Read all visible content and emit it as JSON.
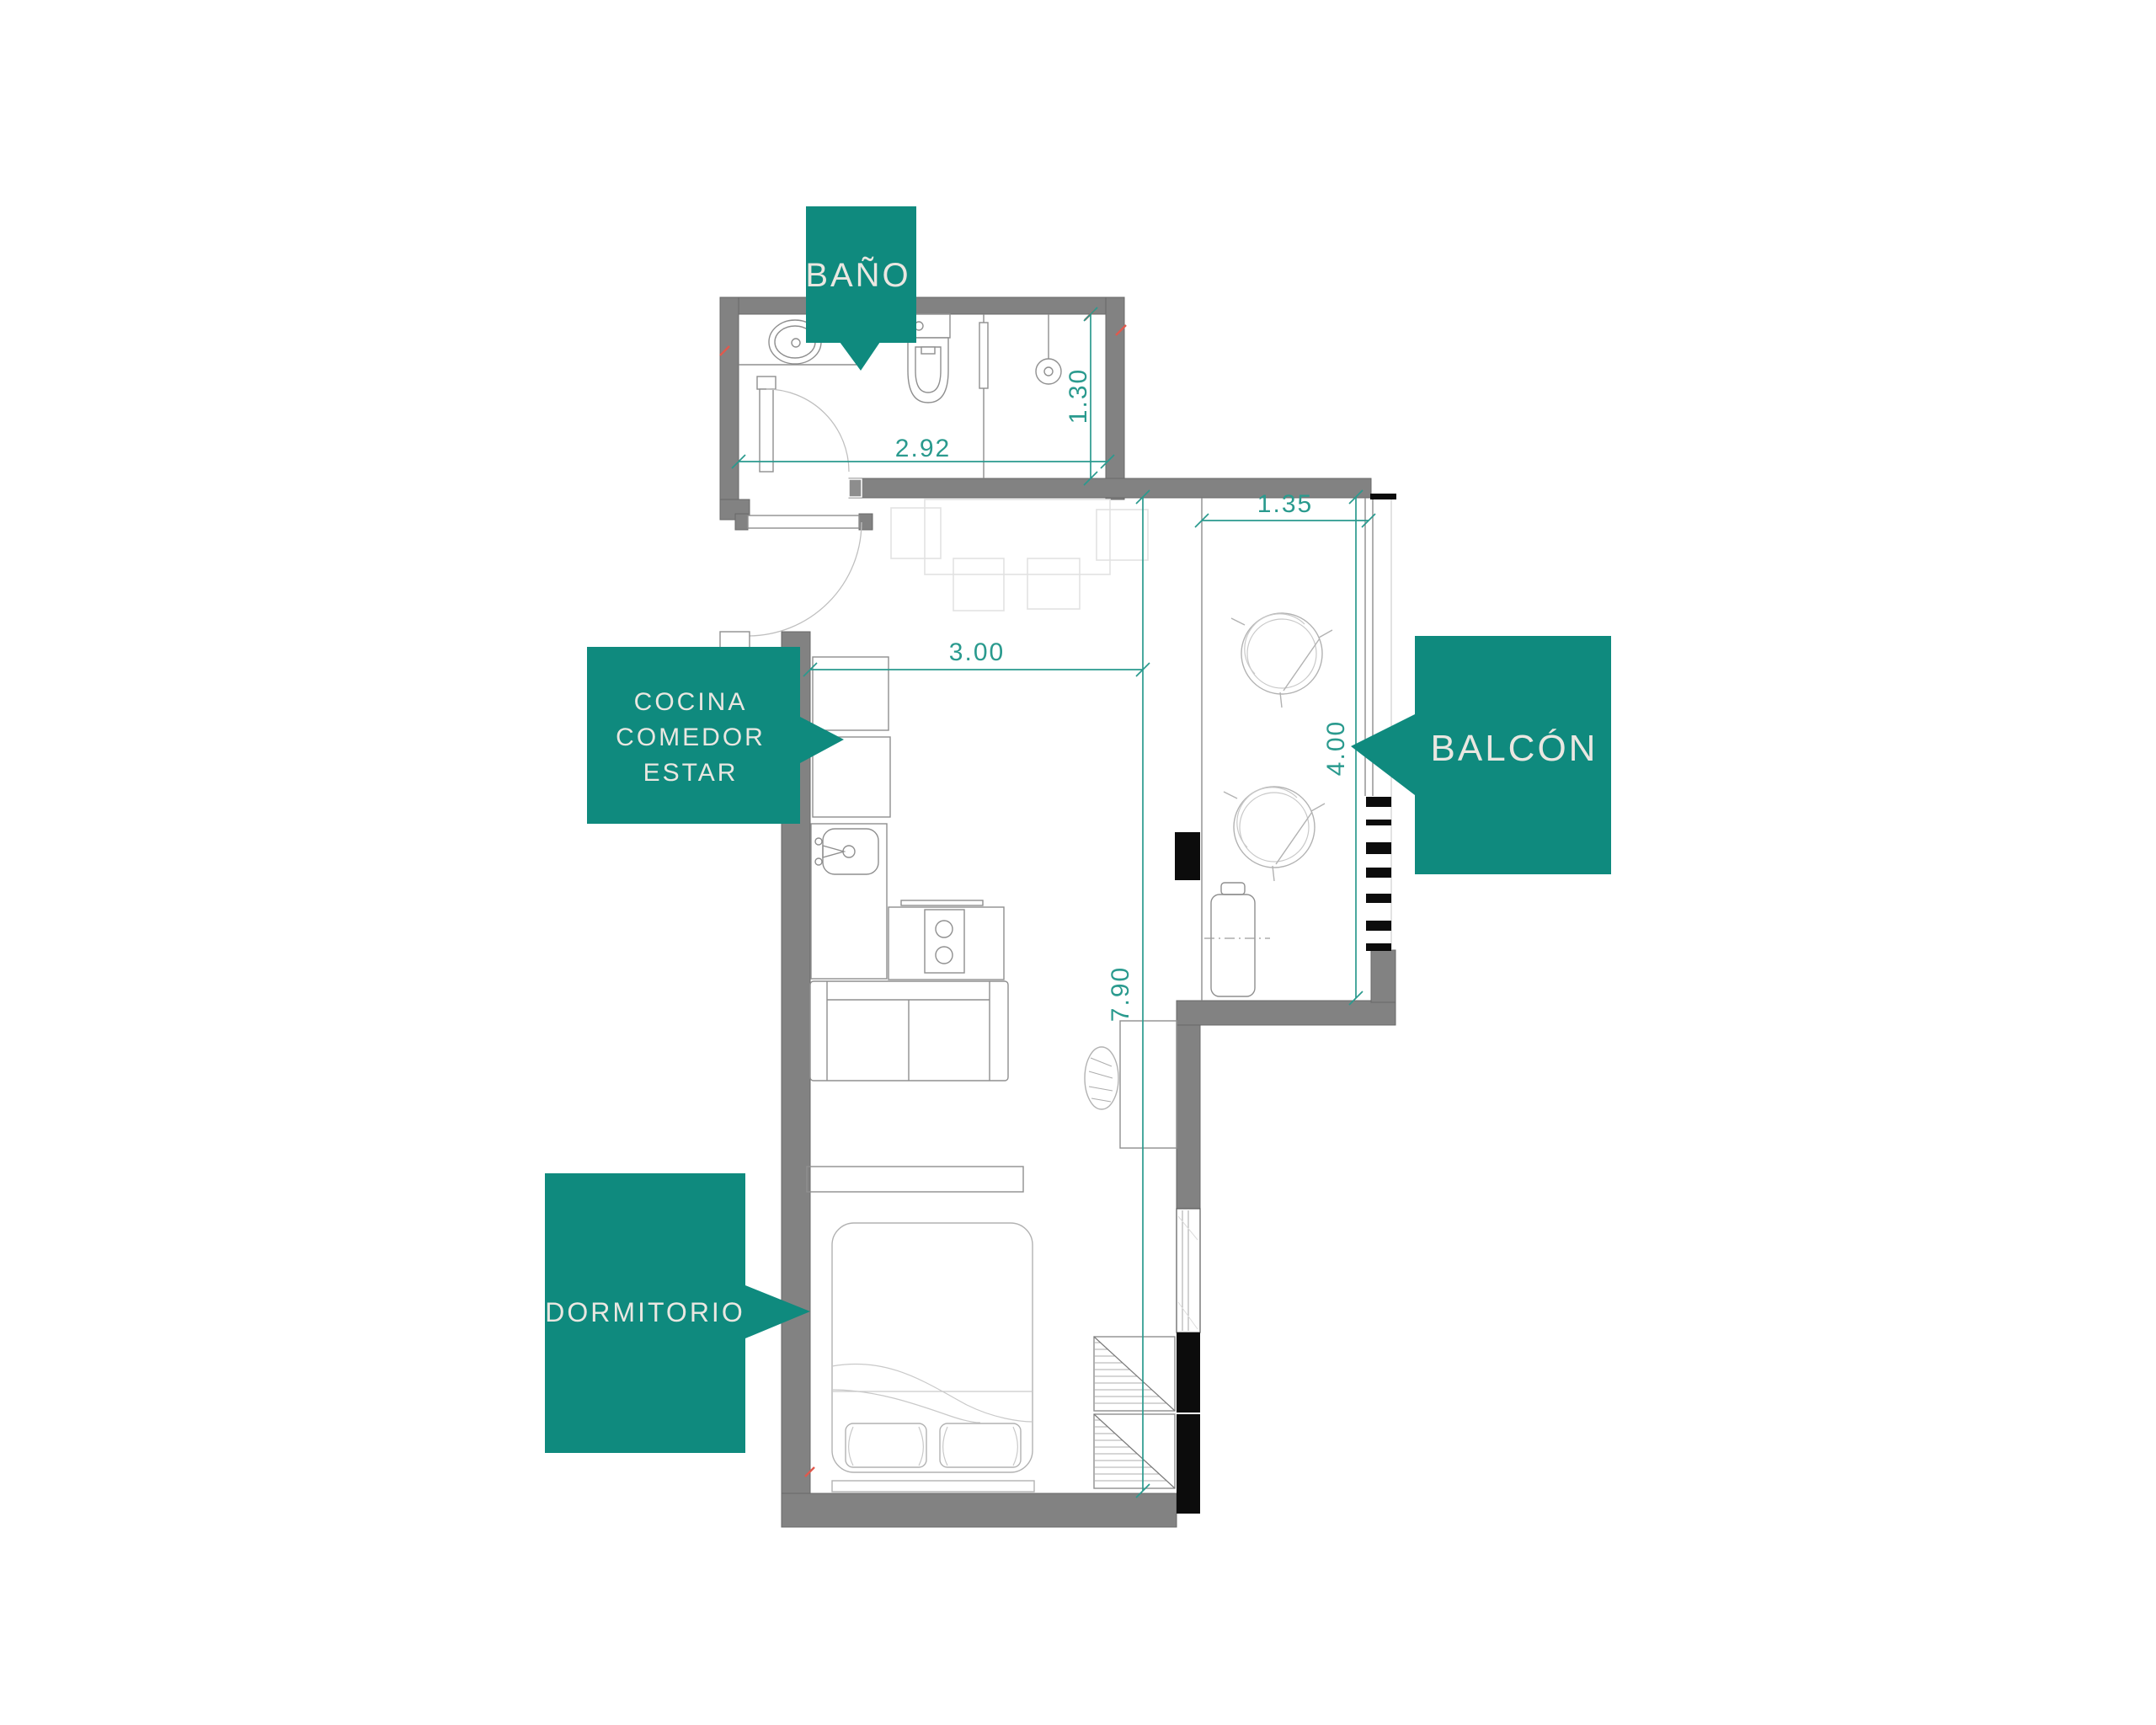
{
  "labels": {
    "bano": "BAÑO",
    "cocina_lines": [
      "COCINA",
      "COMEDOR",
      "ESTAR"
    ],
    "balcon": "BALCÓN",
    "dormitorio": "DORMITORIO"
  },
  "dimensions": {
    "bathroom_width": "2.92",
    "bathroom_depth": "1.30",
    "living_width": "3.00",
    "unit_length": "7.90",
    "balcony_width": "1.35",
    "balcony_length": "4.00"
  },
  "colors": {
    "label_background": "#0f8a7e",
    "label_text": "#eae7e1",
    "dimension_teal": "#2a9a8e",
    "wall_gray": "#828282",
    "structure_black": "#0c0c0c",
    "furniture_line": "#8f8f8f",
    "light_furniture_line": "#e2e2e2",
    "accent_red": "#e0594d",
    "background": "#ffffff"
  }
}
